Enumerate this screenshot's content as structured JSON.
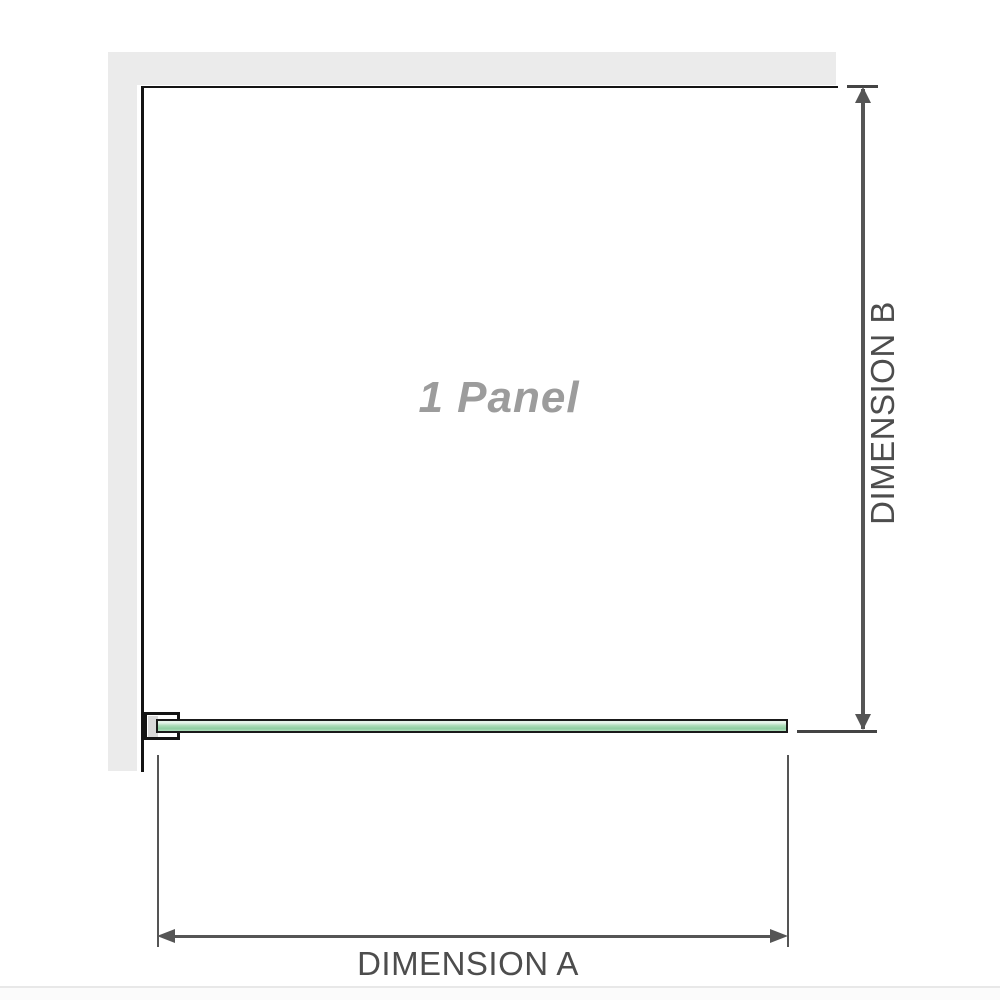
{
  "diagram": {
    "title": "1 panel shower screen dimension diagram",
    "panel_label": "1 Panel",
    "dimension_a_label": "DIMENSION A",
    "dimension_b_label": "DIMENSION B",
    "elements": {
      "walls": [
        "wall-top",
        "wall-left"
      ],
      "glass_panels": 1,
      "bracket": "wall-mount-glass-bracket",
      "dimension_a_axis": "horizontal width of glass panel",
      "dimension_b_axis": "vertical depth from wall to panel"
    },
    "colors": {
      "wall_fill": "#ebebeb",
      "structure_line": "#141414",
      "glass_border": "#1a1a1a",
      "glass_light": "#e6f4ea",
      "glass_mid": "#aedcba",
      "glass_deep": "#8fcfa2",
      "bracket_pad": "#d9d9d9",
      "dimension_line": "#555555",
      "dimension_tick": "#444444",
      "dimension_text": "#4d4d4d",
      "panel_label_color": "#9c9c9c",
      "separator": "#e8e8e8"
    }
  }
}
